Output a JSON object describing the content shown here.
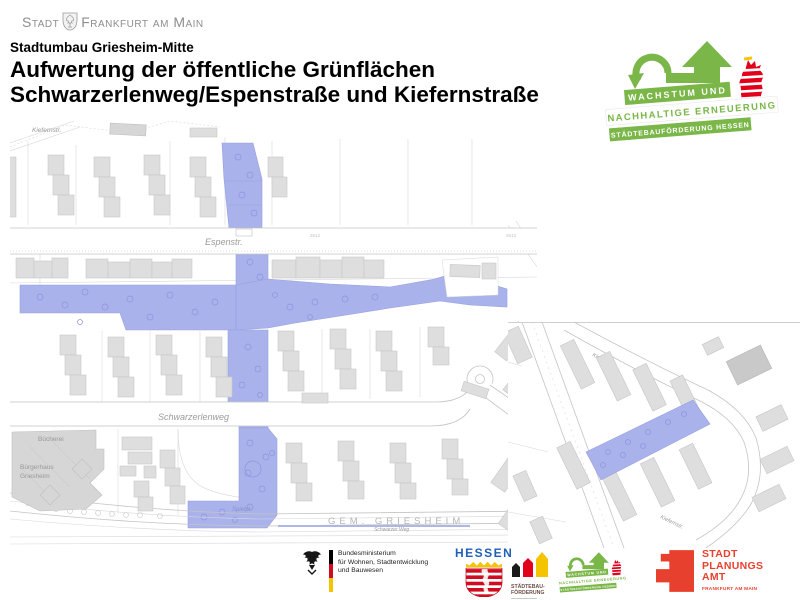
{
  "page": {
    "width": 800,
    "height": 600,
    "background": "#ffffff"
  },
  "header": {
    "city_logo": {
      "stadt": "Stadt",
      "frankfurt": "Frankfurt am Main"
    },
    "subtitle": "Stadtumbau Griesheim-Mitte",
    "title_line1": "Aufwertung der öffentliche Grünflächen",
    "title_line2": "Schwarzerlenweg/Espenstraße und Kiefernstraße"
  },
  "program_logo": {
    "banner1": "WACHSTUM UND",
    "banner2": "NACHHALTIGE ERNEUERUNG",
    "banner3": "STÄDTEBAUFÖRDERUNG HESSEN"
  },
  "colors": {
    "highlight": "#a9b2ea",
    "highlight_stroke": "#97a0e0",
    "program_green": "#7ab648",
    "hessen_blue": "#1f5fb8",
    "lion_red": "#e2001a",
    "spa_red": "#e8402f"
  },
  "main_map": {
    "labels": {
      "kiefernstr": "Kiefernstr.",
      "espenstr": "Espenstr.",
      "schwarzerlenweg": "Schwarzerlenweg",
      "buecherei": "Bücherei",
      "buergerhaus_line1": "Bürgerhaus",
      "buergerhaus_line2": "Griesheim",
      "spielplatz": "Spielpl.",
      "gemarkung": "GEM. GRIESHEIM",
      "schwarzer_weg": "Schwarzer Weg",
      "parcel_2612": "2612",
      "parcel_2613": "2613"
    }
  },
  "inset_map": {
    "labels": {
      "kiefernstr_top": "Kiefernstr.",
      "kiefernstr_bottom": "Kiefernstr."
    }
  },
  "footer": {
    "bund": {
      "line1": "Bundesministerium",
      "line2": "für Wohnen, Stadtentwicklung",
      "line3": "und Bauwesen"
    },
    "hessen": {
      "wordmark": "HESSEN"
    },
    "staedtebau": {
      "line1": "STÄDTEBAU-",
      "line2": "FÖRDERUNG"
    },
    "spa": {
      "line1": "STADT",
      "line2": "PLANUNGS",
      "line3": "AMT",
      "line4": "FRANKFURT AM MAIN"
    }
  }
}
